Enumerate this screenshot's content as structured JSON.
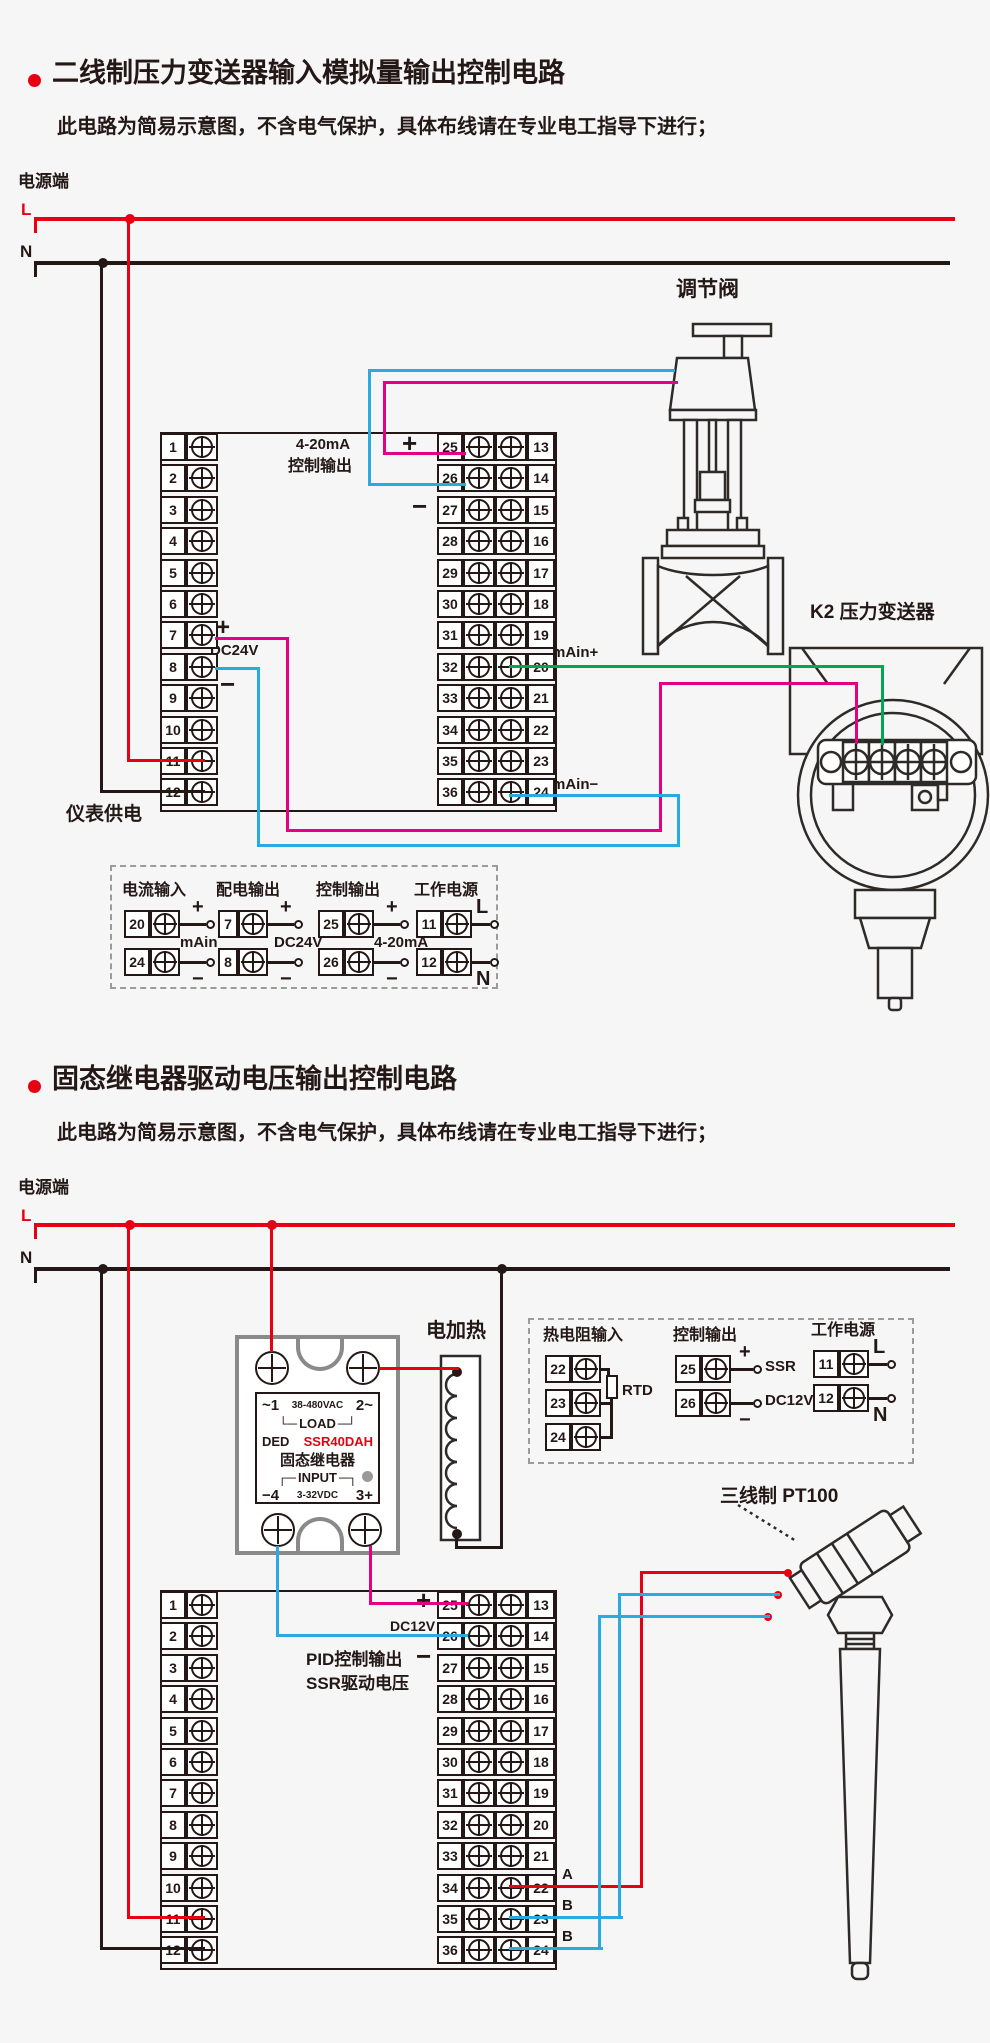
{
  "colors": {
    "red": "#e60012",
    "magenta": "#e4007f",
    "cyan": "#29abe2",
    "green": "#00a651",
    "dark": "#231815",
    "gray": "#9b9b9b"
  },
  "sec1": {
    "title": "二线制压力变送器输入模拟量输出控制电路",
    "subtitle": "此电路为简易示意图，不含电气保护，具体布线请在专业电工指导下进行；",
    "power_label": "电源端",
    "l": "L",
    "n": "N",
    "valve_label": "调节阀",
    "transmitter_label": "K2 压力变送器",
    "tx_signs": "+ − + −",
    "tx_ab": "A B A",
    "block": {
      "header1": "4-20mA",
      "header2": "控制输出",
      "plus": "+",
      "minus": "−",
      "dc24v": "DC24V",
      "main_plus": "mAin+",
      "main_minus": "mAin−",
      "supply": "仪表供电",
      "left": [
        "1",
        "2",
        "3",
        "4",
        "5",
        "6",
        "7",
        "8",
        "9",
        "10",
        "11",
        "12"
      ],
      "mid": [
        "25",
        "26",
        "27",
        "28",
        "29",
        "30",
        "31",
        "32",
        "33",
        "34",
        "35",
        "36"
      ],
      "right": [
        "13",
        "14",
        "15",
        "16",
        "17",
        "18",
        "19",
        "20",
        "21",
        "22",
        "23",
        "24"
      ]
    },
    "legend": {
      "groups": [
        {
          "title": "电流输入",
          "rows": [
            {
              "n": "20",
              "sign": "+"
            },
            {
              "n": "24",
              "sign": "−"
            }
          ],
          "tail": "mAin"
        },
        {
          "title": "配电输出",
          "rows": [
            {
              "n": "7",
              "sign": "+"
            },
            {
              "n": "8",
              "sign": "−"
            }
          ],
          "tail": "DC24V"
        },
        {
          "title": "控制输出",
          "rows": [
            {
              "n": "25",
              "sign": "+"
            },
            {
              "n": "26",
              "sign": "−"
            }
          ],
          "tail": "4-20mA"
        },
        {
          "title": "工作电源",
          "rows": [
            {
              "n": "11",
              "sign": "L"
            },
            {
              "n": "12",
              "sign": "N"
            }
          ],
          "tail": ""
        }
      ]
    }
  },
  "sec2": {
    "title": "固态继电器驱动电压输出控制电路",
    "subtitle": "此电路为简易示意图，不含电气保护，具体布线请在专业电工指导下进行；",
    "power_label": "电源端",
    "l": "L",
    "n": "N",
    "heater_label": "电加热",
    "pt100_label": "三线制 PT100",
    "ssr": {
      "l1a": "~1",
      "l1b": "38-480VAC",
      "l1c": "2~",
      "load_l": "└─",
      "load": "LOAD",
      "load_r": "─┘",
      "brand": "DED",
      "model": "SSR40DAH",
      "name": "固态继电器",
      "input_l": "┌─",
      "input": "INPUT",
      "input_r": "─┐",
      "l6a": "−4",
      "l6b": "3-32VDC",
      "l6c": "3+"
    },
    "block": {
      "plus": "+",
      "minus": "−",
      "dc12v": "DC12V",
      "pid1": "PID控制输出",
      "pid2": "SSR驱动电压",
      "a": "A",
      "b1": "B",
      "b2": "B",
      "left": [
        "1",
        "2",
        "3",
        "4",
        "5",
        "6",
        "7",
        "8",
        "9",
        "10",
        "11",
        "12"
      ],
      "mid": [
        "25",
        "26",
        "27",
        "28",
        "29",
        "30",
        "31",
        "32",
        "33",
        "34",
        "35",
        "36"
      ],
      "right": [
        "13",
        "14",
        "15",
        "16",
        "17",
        "18",
        "19",
        "20",
        "21",
        "22",
        "23",
        "24"
      ]
    },
    "legend": {
      "groups": [
        {
          "title": "热电阻输入",
          "type": "rtd",
          "rows": [
            {
              "n": "22"
            },
            {
              "n": "23"
            },
            {
              "n": "24"
            }
          ],
          "tail": "RTD"
        },
        {
          "title": "控制输出",
          "rows": [
            {
              "n": "25",
              "sign": "+",
              "label": "SSR"
            },
            {
              "n": "26",
              "sign": "−",
              "label": "DC12V"
            }
          ]
        },
        {
          "title": "工作电源",
          "rows": [
            {
              "n": "11",
              "sign": "L"
            },
            {
              "n": "12",
              "sign": "N"
            }
          ]
        }
      ]
    }
  }
}
